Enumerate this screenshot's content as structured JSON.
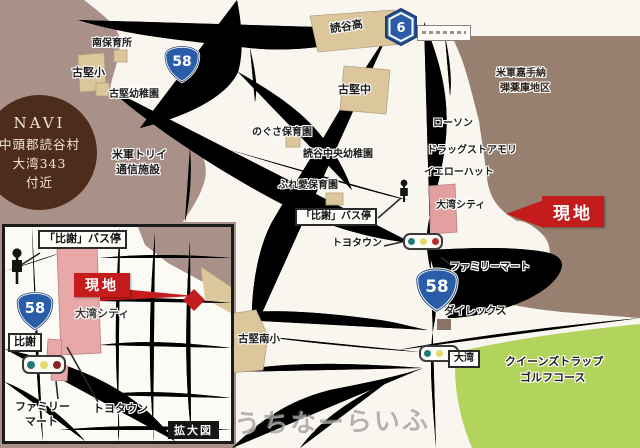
{
  "navi": {
    "title": "NAVI",
    "address_line1": "中頭郡読谷村",
    "address_line2": "大湾343",
    "address_line3": "付近"
  },
  "shields": {
    "route58": "58",
    "route6": "6"
  },
  "site_marker": {
    "label": "現地"
  },
  "main_map": {
    "minami_hoikusho": "南保育所",
    "furugen_elementary": "古堅小",
    "furugen_kindergarten": "古堅幼稚園",
    "yomitan_high_school": "読谷高",
    "furugen_junior_high": "古堅中",
    "nogusa_nursery": "のぐさ保育園",
    "yomitan_central_kindergarten": "読谷中央幼稚園",
    "fureai_nursery": "ふれ愛保育園",
    "hija_bus_stop": "「比謝」バス停",
    "toyotown": "トヨタウン",
    "torii_station_line1": "米軍トリイ",
    "torii_station_line2": "通信施設",
    "kadena_depot_line1": "米軍嘉手納",
    "kadena_depot_line2": "弾薬庫地区",
    "lawson": "ローソン",
    "drugstore_mori": "ドラッグストアモリ",
    "yellow_hat": "イエローハット",
    "owan_city": "大湾シティ",
    "familymart": "ファミリーマート",
    "direx": "ダイレックス",
    "owan_intersection": "大湾",
    "furugen_minami_elementary": "古堅南小",
    "golf_course_line1": "クイーンズトラップ",
    "golf_course_line2": "ゴルフコース"
  },
  "inset_map": {
    "hija_bus_stop": "「比謝」バス停",
    "hija_intersection": "比謝",
    "owan_city": "大湾シティ",
    "familymart_line1": "ファミリー",
    "familymart_line2": "マート",
    "toyotown": "トヨタウン",
    "enlarged_map_label": "拡大図"
  },
  "watermark": "うちなーらいふ",
  "colors": {
    "background": "#a9918a",
    "land": "#f8f6ef",
    "military_area": "#97806f",
    "building_tan": "#dcc69c",
    "building_pink": "#e2a0a0",
    "golf_green": "#b2d45c",
    "site_red": "#c41c1c",
    "navi_circle": "#4e2c1b",
    "route_blue": "#2a5da8"
  }
}
